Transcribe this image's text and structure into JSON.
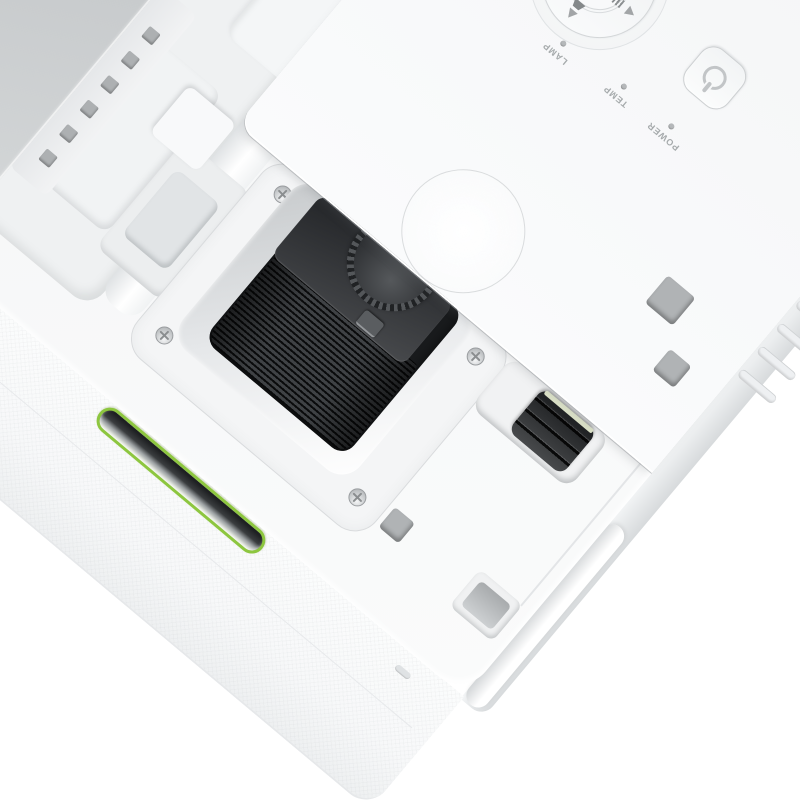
{
  "image": {
    "type": "product-photo",
    "description": "Top view of a white LCD projector rotated diagonally on a white background; lamp cover removed exposing the lens compartment with ribbed focus ring and knurled zoom dial, a black A/V mute slide lever, a control panel with directional keypad and power button, indicator labels, and a green accent stripe on the front face"
  },
  "control_panel": {
    "center_button_label": "OK",
    "indicators": [
      {
        "label": "POWER",
        "led_state": "off"
      },
      {
        "label": "TEMP",
        "led_state": "off"
      },
      {
        "label": "LAMP",
        "led_state": "off"
      }
    ],
    "icons": [
      "power-icon",
      "arrow-up-icon",
      "arrow-down-icon",
      "arrow-left-icon",
      "arrow-right-icon",
      "keystone-up-icon",
      "keystone-down-icon",
      "volume-bars-icon"
    ]
  },
  "hardware": {
    "screws_visible": 4,
    "vent_holes_on_compartment": 6,
    "side_vent_slats": 5
  },
  "colors": {
    "background": "#ffffff",
    "body_white": "#f6f7f8",
    "panel_gray": "#c7cacc",
    "lens_black": "#232527",
    "accent_green": "#8dc63f",
    "label_gray": "#a6aaac"
  }
}
